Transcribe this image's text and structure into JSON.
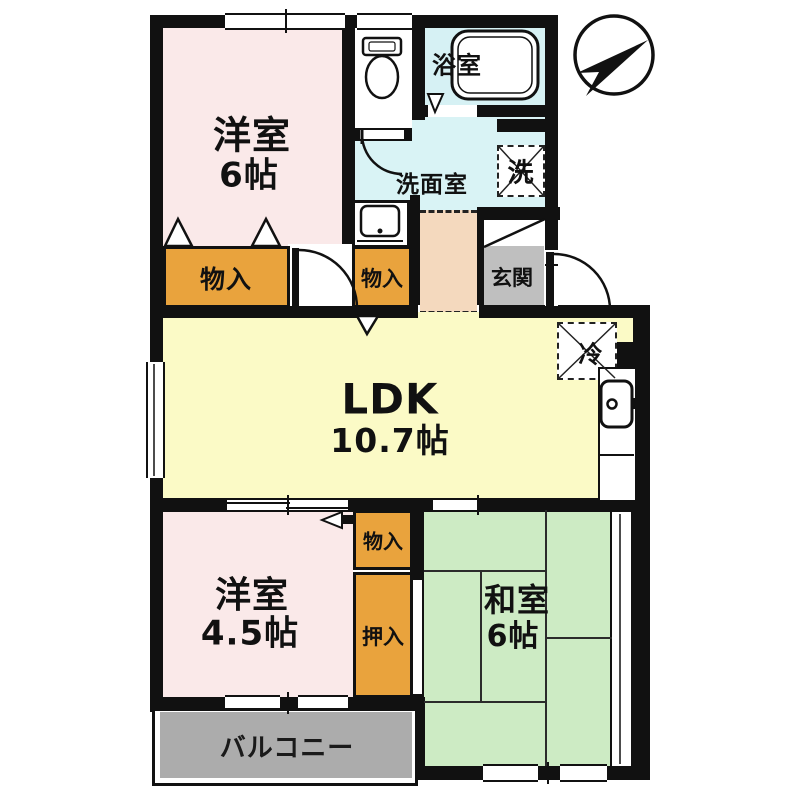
{
  "plan": {
    "compass": {
      "icon": "north-arrow-icon"
    },
    "rooms": {
      "bedroom1": {
        "name": "洋室",
        "size": "6帖"
      },
      "bath": {
        "name": "浴室"
      },
      "washroom": {
        "name": "洗面室"
      },
      "washer_box": {
        "label": "洗"
      },
      "fridge_box": {
        "label": "冷"
      },
      "genkan": {
        "name": "玄関"
      },
      "closet_bedroom1": {
        "label": "物入"
      },
      "closet_hall": {
        "label": "物入"
      },
      "ldk": {
        "name": "LDK",
        "size": "10.7帖"
      },
      "bedroom2": {
        "name": "洋室",
        "size": "4.5帖"
      },
      "closet_bedroom2": {
        "label": "物入"
      },
      "oshiire": {
        "label": "押入"
      },
      "washitsu": {
        "name": "和室",
        "size": "6帖"
      },
      "balcony": {
        "name": "バルコニー"
      }
    },
    "colors": {
      "wall": "#111111",
      "bedroom_pink": "#FAE9E9",
      "ldk_yellow": "#FBFAC6",
      "washitsu_green": "#CDEBC4",
      "wet_area_cyan": "#D9F3F5",
      "closet_orange": "#E9A33D",
      "hall_peach": "#F4D9BE",
      "genkan_gray": "#BFBFBF",
      "balcony_gray": "#ACACAC"
    }
  }
}
